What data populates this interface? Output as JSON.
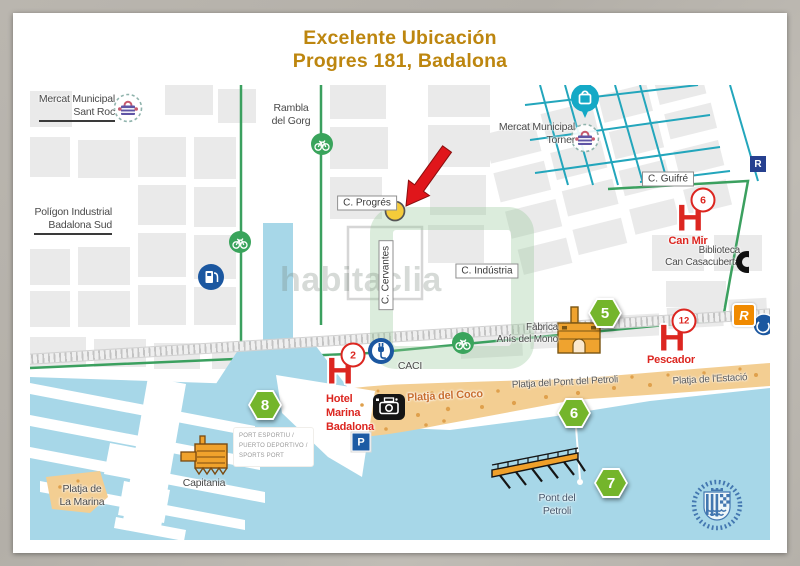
{
  "title": {
    "line1": "Excelente Ubicación",
    "line2": "Progres 181, Badalona"
  },
  "watermark": "habitaclia",
  "streets": {
    "guifre": "C. Guifré",
    "progres": "C. Progrés",
    "cervantes": "C. Cervantes",
    "industria": "C. Indústria"
  },
  "places": {
    "mercat_sant_roc": {
      "l1": "Mercat Municipal",
      "l2": "Sant Roc"
    },
    "poligon": {
      "l1": "Polígon Industrial",
      "l2": "Badalona Sud"
    },
    "rambla": {
      "l1": "Rambla",
      "l2": "del Gorg"
    },
    "mercat_torner": {
      "l1": "Mercat Municipal",
      "l2": "Torner"
    },
    "biblioteca": {
      "l1": "Biblioteca",
      "l2": "Can Casacuberta"
    },
    "fabrica": {
      "l1": "Fàbrica",
      "l2": "Anís del Mono"
    },
    "caci": "CACI",
    "capitania": "Capitania",
    "platja_coco": "Platja del Coco",
    "platja_pont": "Platja del Pont del Petroli",
    "platja_estacio": "Platja de l'Estació",
    "platja_marina": {
      "l1": "Platja de",
      "l2": "La Marina"
    },
    "pont_petroli": {
      "l1": "Pont del",
      "l2": "Petroli"
    },
    "port": {
      "l1": "PORT ESPORTIU /",
      "l2": "PUERTO DEPORTIVO /",
      "l3": "SPORTS PORT"
    }
  },
  "markers": {
    "can_mir": {
      "badge": "6",
      "name": "Can Mir"
    },
    "hotel": {
      "badge": "2",
      "l1": "Hotel",
      "l2": "Marina",
      "l3": "Badalona"
    },
    "pescador": {
      "badge": "12",
      "name": "Pescador"
    },
    "hex5": "5",
    "hex8": "8",
    "hex6": "6",
    "hex7": "7",
    "parking": "P",
    "renfe_r": "R",
    "rodalies_r": "R"
  },
  "colors": {
    "title": "#BD860F",
    "red": "#DC2620",
    "green_route": "#3BA05F",
    "hex_green": "#74B52B",
    "teal": "#23A6BC",
    "water": "#A7D7E8",
    "beach": "#F3CE92",
    "blue": "#1B57A0",
    "orange": "#F08A00"
  }
}
